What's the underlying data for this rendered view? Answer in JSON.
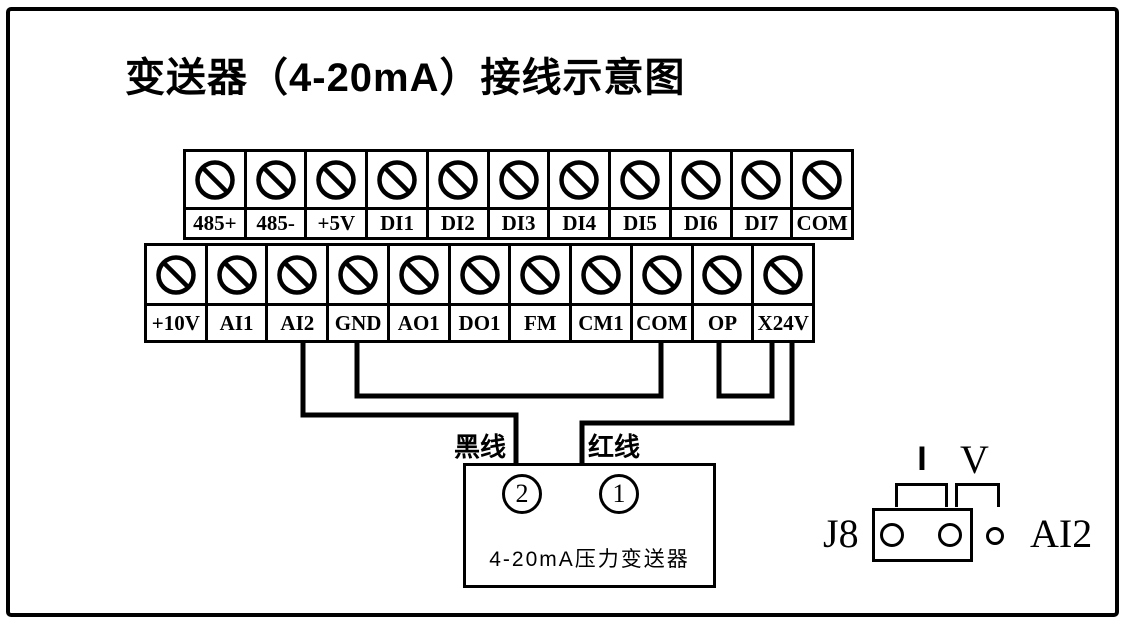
{
  "title": "变送器（4-20mA）接线示意图",
  "terminals": {
    "top_row": [
      "485+",
      "485-",
      "+5V",
      "DI1",
      "DI2",
      "DI3",
      "DI4",
      "DI5",
      "DI6",
      "DI7",
      "COM"
    ],
    "bottom_row": [
      "+10V",
      "AI1",
      "AI2",
      "GND",
      "AO1",
      "DO1",
      "FM",
      "CM1",
      "COM",
      "OP",
      "X24V"
    ]
  },
  "wire_labels": {
    "black": "黑线",
    "red": "红线"
  },
  "connections": [
    {
      "from": "AI2",
      "to": "transmitter-pin-2",
      "wire": "黑线"
    },
    {
      "from": "GND",
      "to": "COM",
      "wire": "jumper-link"
    },
    {
      "from": "OP",
      "to": "X24V",
      "wire": "jumper-link"
    },
    {
      "from": "X24V",
      "to": "transmitter-pin-1",
      "wire": "红线"
    }
  ],
  "transmitter": {
    "pin2": "2",
    "pin1": "1",
    "name": "4-20mA压力变送器"
  },
  "jumper": {
    "name": "J8",
    "channel": "AI2",
    "current_label": "I",
    "voltage_label": "V",
    "selected_mode": "I"
  },
  "colors": {
    "ink": "#000000",
    "background": "#ffffff"
  }
}
